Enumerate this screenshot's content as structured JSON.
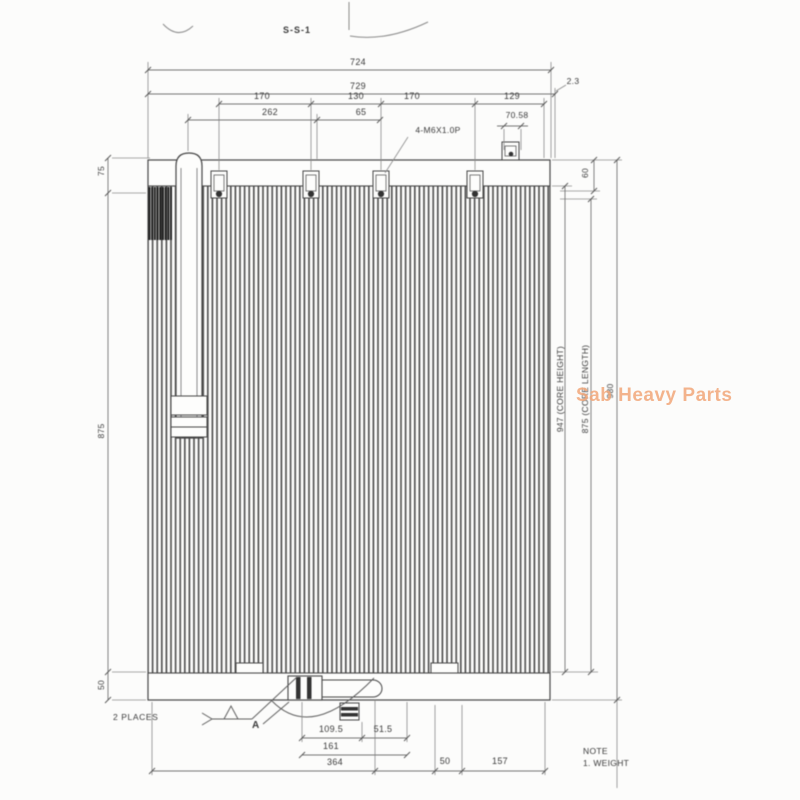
{
  "title_block": {
    "section_label": "S-S-1",
    "note_title": "NOTE",
    "note_line1": "1. WEIGHT"
  },
  "watermark": {
    "text": "Sab Heavy Parts",
    "color": "#f1a678"
  },
  "callouts": {
    "tap_holes": "4-M6X1.0P",
    "weld_places": "2 PLACES",
    "detail_label": "A",
    "thickness": "2.3"
  },
  "dimensions": {
    "overall_width_1": "724",
    "overall_width_2": "729",
    "bracket_spacing": [
      "170",
      "130",
      "170",
      "129"
    ],
    "offset_262": "262",
    "offset_65": "65",
    "offset_70_58": "70.58",
    "top_right_60": "60",
    "left_top_75": "75",
    "left_mid_875": "875",
    "left_bottom_50": "50",
    "core_height": "947 (CORE HEIGHT)",
    "core_length": "875 (CORE LENGTH)",
    "overall_height": "980",
    "bottom_109_5": "109.5",
    "bottom_51_5": "51.5",
    "bottom_161": "161",
    "bottom_364": "364",
    "bottom_50": "50",
    "bottom_157": "157"
  },
  "colors": {
    "line": "#454545",
    "dim_line": "#757575"
  }
}
